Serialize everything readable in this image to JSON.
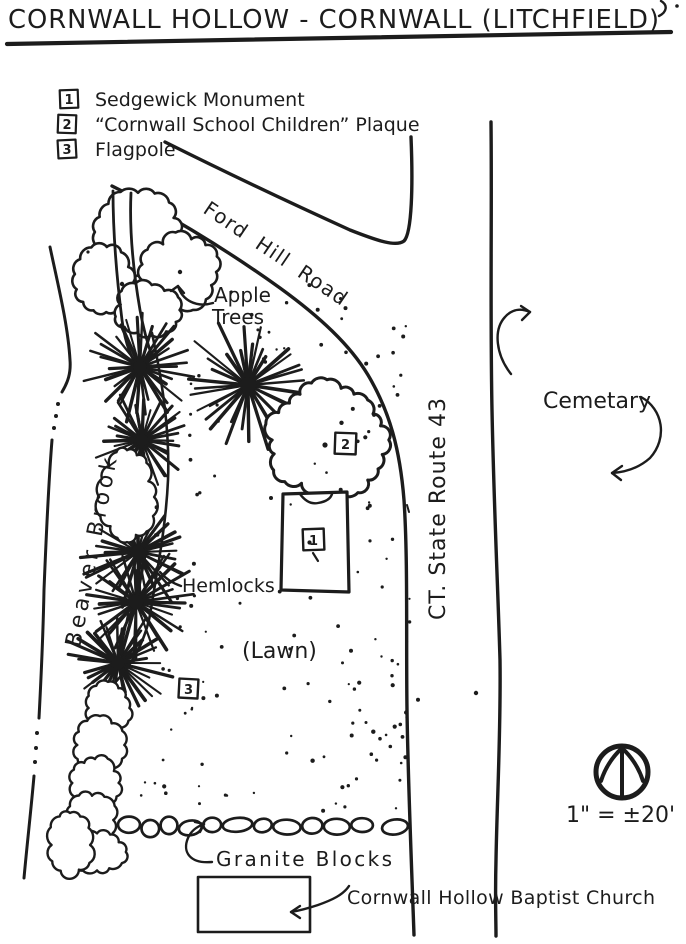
{
  "title": "CORNWALL HOLLOW - CORNWALL (LITCHFIELD)",
  "legend": {
    "items": [
      {
        "num": "1",
        "label": "Sedgewick Monument"
      },
      {
        "num": "2",
        "label": "“Cornwall School Children” Plaque"
      },
      {
        "num": "3",
        "label": "Flagpole"
      }
    ]
  },
  "labels": {
    "ford_hill_road": "Ford Hill Road",
    "apple_line1": "Apple",
    "apple_line2": "Trees",
    "beaver_brook": "Beaver Brook",
    "hemlocks": "Hemlocks",
    "lawn": "(Lawn)",
    "route43": "CT. State Route 43",
    "cemetary": "Cemetary",
    "granite_blocks": "Granite Blocks",
    "church": "Cornwall Hollow Baptist Church",
    "scale": "1\" = ±20'"
  },
  "markers": {
    "monument": "1",
    "plaque": "2",
    "flagpole": "3"
  },
  "colors": {
    "ink": "#1c1c1c",
    "paper": "#ffffff"
  }
}
